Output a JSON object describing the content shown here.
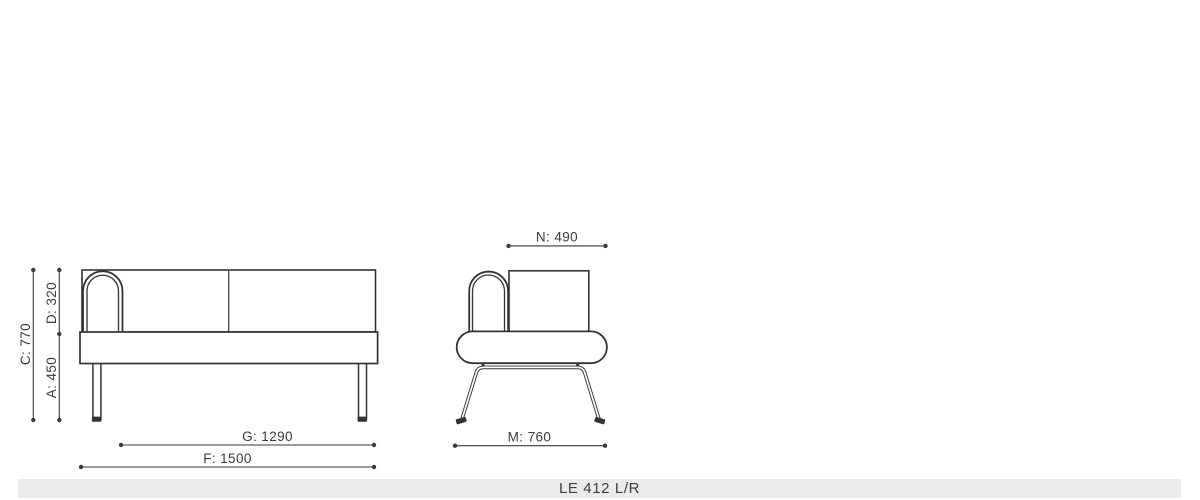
{
  "product": {
    "model_label": "LE 412 L/R"
  },
  "drawing": {
    "front_view": {
      "dim_total_height": "C: 770",
      "dim_backrest_height": "D: 320",
      "dim_seat_height": "A: 450",
      "dim_inner_width": "G: 1290",
      "dim_total_width": "F: 1500"
    },
    "side_view": {
      "dim_inner_depth": "N: 490",
      "dim_total_depth": "M: 760"
    }
  },
  "colors": {
    "outline": "#333333",
    "dimension_line": "#3a3a3a",
    "label_text": "#3c3c3c",
    "footer_background": "#ebebeb"
  }
}
